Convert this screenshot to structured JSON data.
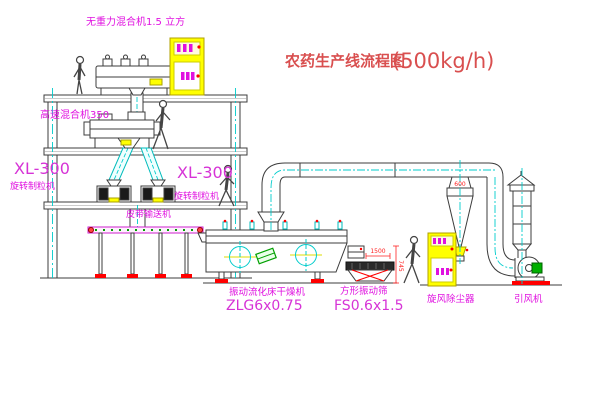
{
  "title": {
    "name": "农药生产线流程图",
    "capacity": "(500kg/h)"
  },
  "equipment_labels": {
    "gravity_mixer": "无重力混合机1.5 立方",
    "high_speed_mixer": "高速混合机350",
    "granulator_left": {
      "model": "XL-300",
      "name": "旋转制粒机"
    },
    "granulator_right": {
      "model": "XL-300",
      "name": "旋转制粒机"
    },
    "belt_conveyor": "皮带输送机",
    "fluid_bed_dryer": {
      "name": "振动流化床干燥机",
      "model": "ZLG6x0.75"
    },
    "square_vibrating_sieve": {
      "name": "方形振动筛",
      "model": "FS0.6x1.5"
    },
    "cyclone_dust_collector": "旋风除尘器",
    "induced_draft_fan": "引风机"
  },
  "dimension_annotations": {
    "cyclone_inlet": "600",
    "sieve_length": "1500",
    "sieve_height": "745"
  },
  "colors": {
    "label_magenta": "#e011e0",
    "title_red": "#d94f4f",
    "line_dark": "#3c3c3c",
    "centerline_cyan": "#00cccc",
    "cabinet_yellow": "#ffff00",
    "accent_red": "#ff0000",
    "accent_green": "#00a000"
  }
}
